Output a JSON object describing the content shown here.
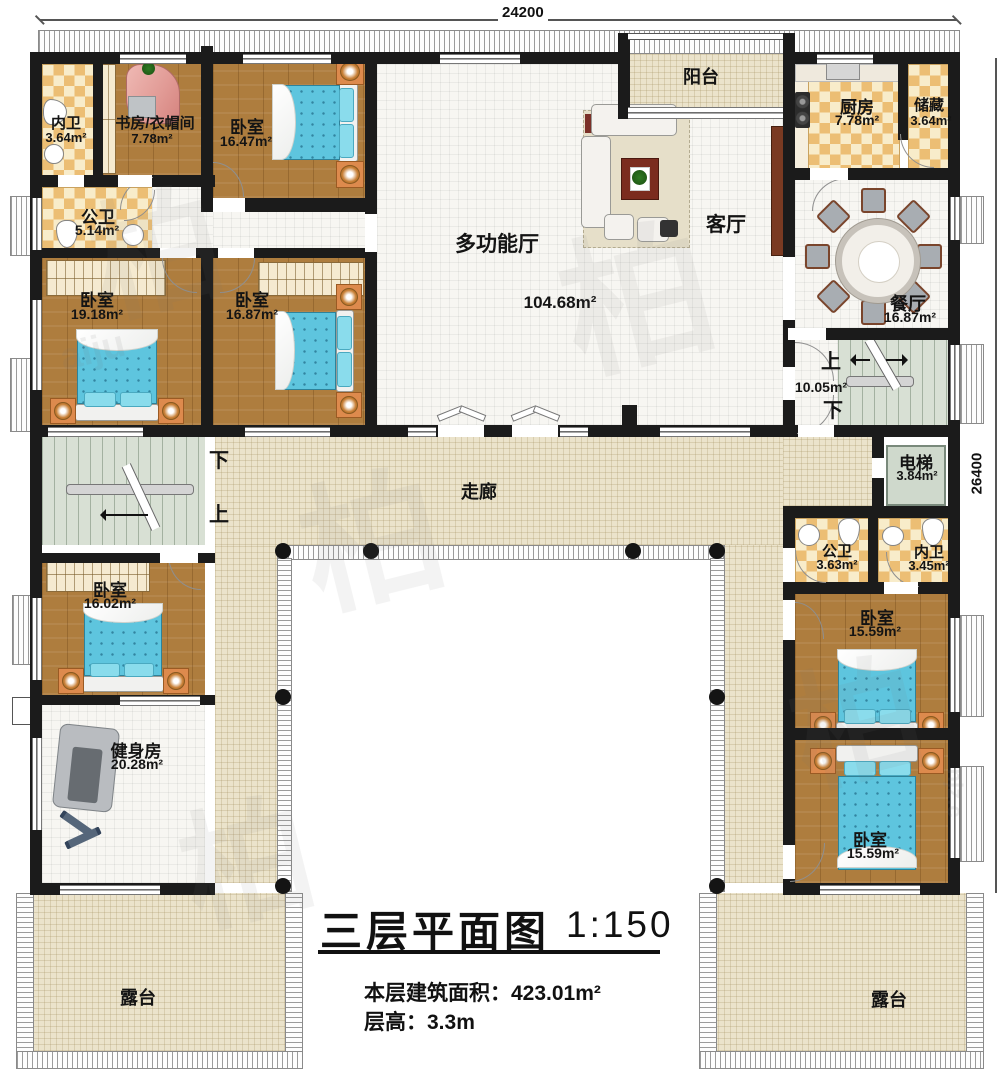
{
  "dimensions": {
    "top": "24200",
    "right": "26400"
  },
  "labels": {
    "balcony": "阳台",
    "living": "客厅",
    "corridor": "走廊",
    "multi_hall": "多功能厅",
    "multi_hall_area": "104.68m²",
    "terrace_left": "露台",
    "terrace_right": "露台",
    "up": "上",
    "down": "下",
    "stair_area_right": "10.05m²"
  },
  "rooms": {
    "inner_bath_tl": {
      "name": "内卫",
      "area": "3.64m²"
    },
    "study_cloak": {
      "name": "书房/衣帽间",
      "area": "7.78m²"
    },
    "bedroom_tl": {
      "name": "卧室",
      "area": "16.47m²"
    },
    "public_bath_tl": {
      "name": "公卫",
      "area": "5.14m²"
    },
    "bedroom_l1": {
      "name": "卧室",
      "area": "19.18m²"
    },
    "bedroom_l2": {
      "name": "卧室",
      "area": "16.87m²"
    },
    "kitchen": {
      "name": "厨房",
      "area": "7.78m²"
    },
    "storage": {
      "name": "储藏",
      "area": "3.64m²"
    },
    "dining": {
      "name": "餐厅",
      "area": "16.87m²"
    },
    "elevator": {
      "name": "电梯",
      "area": "3.84m²"
    },
    "public_bath_r": {
      "name": "公卫",
      "area": "3.63m²"
    },
    "inner_bath_r": {
      "name": "内卫",
      "area": "3.45m²"
    },
    "bedroom_r1": {
      "name": "卧室",
      "area": "15.59m²"
    },
    "bedroom_r2": {
      "name": "卧室",
      "area": "15.59m²"
    },
    "bedroom_bl": {
      "name": "卧室",
      "area": "16.02m²"
    },
    "gym": {
      "name": "健身房",
      "area": "20.28m²"
    }
  },
  "title": {
    "main": "三层平面图",
    "scale": "1:150",
    "area_label": "本层建筑面积：",
    "area_value": "423.01m²",
    "height_label": "层高：",
    "height_value": "3.3m"
  },
  "watermark": {
    "glyph": "柏",
    "frag_a": "aiju",
    "frag_b": "njz.c"
  }
}
